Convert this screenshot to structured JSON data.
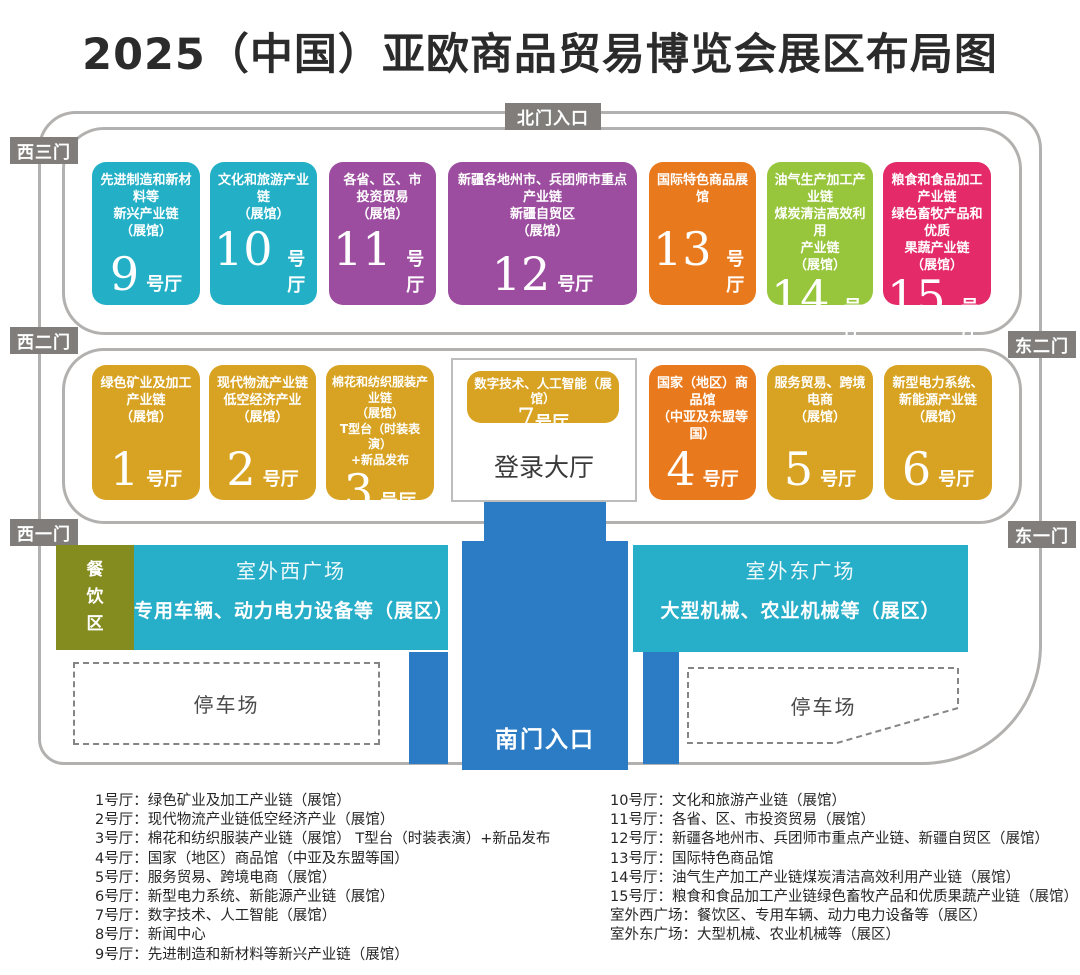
{
  "title": "2025（中国）亚欧商品贸易博览会展区布局图",
  "gates": {
    "north": "北门入口",
    "west3": "西三门",
    "west2": "西二门",
    "west1": "西一门",
    "east2": "东二门",
    "east1": "东一门",
    "south": "南门入口"
  },
  "hall_suffix": "号厅",
  "halls": {
    "h1": {
      "number": "1",
      "suffix": "号厅",
      "name": "绿色矿业及加工\n产业链\n（展馆）"
    },
    "h2": {
      "number": "2",
      "suffix": "号厅",
      "name": "现代物流产业链\n低空经济产业\n（展馆）"
    },
    "h3": {
      "number": "3",
      "suffix": "号厅",
      "name": "棉花和纺织服装产业链\n（展馆）\nT型台（时装表演）\n+新品发布"
    },
    "h4": {
      "number": "4",
      "suffix": "号厅",
      "name": "国家（地区）商品馆\n（中亚及东盟等国）"
    },
    "h5": {
      "number": "5",
      "suffix": "号厅",
      "name": "服务贸易、跨境电商\n（展馆）"
    },
    "h6": {
      "number": "6",
      "suffix": "号厅",
      "name": "新型电力系统、\n新能源产业链\n（展馆）"
    },
    "h7": {
      "number": "7",
      "suffix": "号厅",
      "name": "数字技术、人工智能（展馆）"
    },
    "h9": {
      "number": "9",
      "suffix": "号厅",
      "name": "先进制造和新材料等\n新兴产业链\n（展馆）"
    },
    "h10": {
      "number": "10",
      "suffix": "号厅",
      "name": "文化和旅游产业链\n（展馆）"
    },
    "h11": {
      "number": "11",
      "suffix": "号厅",
      "name": "各省、区、市\n投资贸易\n（展馆）"
    },
    "h12": {
      "number": "12",
      "suffix": "号厅",
      "name": "新疆各地州市、兵团师市重点产业链\n新疆自贸区\n（展馆）"
    },
    "h13": {
      "number": "13",
      "suffix": "号厅",
      "name": "国际特色商品展馆"
    },
    "h14": {
      "number": "14",
      "suffix": "号厅",
      "name": "油气生产加工产业链\n煤炭清洁高效利用\n产业链\n（展馆）"
    },
    "h15": {
      "number": "15",
      "suffix": "号厅",
      "name": "粮食和食品加工产业链\n绿色畜牧产品和优质\n果蔬产业链\n（展馆）"
    }
  },
  "login_hall": "登录大厅",
  "dining_area": "餐\n饮\n区",
  "west_plaza": {
    "title": "室外西广场",
    "desc": "专用车辆、动力电力设备等（展区）"
  },
  "east_plaza": {
    "title": "室外东广场",
    "desc": "大型机械、农业机械等（展区）"
  },
  "parking": "停车场",
  "legend": {
    "left": [
      "1号厅：绿色矿业及加工产业链（展馆）",
      "2号厅：现代物流产业链低空经济产业（展馆）",
      "3号厅：棉花和纺织服装产业链（展馆） T型台（时装表演）+新品发布",
      "4号厅：国家（地区）商品馆（中亚及东盟等国）",
      "5号厅：服务贸易、跨境电商（展馆）",
      "6号厅：新型电力系统、新能源产业链（展馆）",
      "7号厅：数字技术、人工智能（展馆）",
      "8号厅：新闻中心",
      "9号厅：先进制造和新材料等新兴产业链（展馆）"
    ],
    "right": [
      "10号厅：文化和旅游产业链（展馆）",
      "11号厅：各省、区、市投资贸易（展馆）",
      "12号厅：新疆各地州市、兵团师市重点产业链、新疆自贸区（展馆）",
      "13号厅：国际特色商品馆",
      "14号厅：油气生产加工产业链煤炭清洁高效利用产业链（展馆）",
      "15号厅：粮食和食品加工产业链绿色畜牧产品和优质果蔬产业链（展馆）",
      "室外西广场：餐饮区、专用车辆、动力电力设备等（展区）",
      "室外东广场：大型机械、农业机械等（展区）"
    ]
  },
  "colors": {
    "teal": "#23b0c7",
    "purple": "#9c4d9f",
    "orange": "#e9791d",
    "green": "#97c53b",
    "pink": "#e42a68",
    "gold": "#d8a322",
    "blue": "#2b7cc4",
    "olive": "#848c20",
    "plaza_teal": "#27aec8",
    "gate_gray": "#807d7a"
  }
}
